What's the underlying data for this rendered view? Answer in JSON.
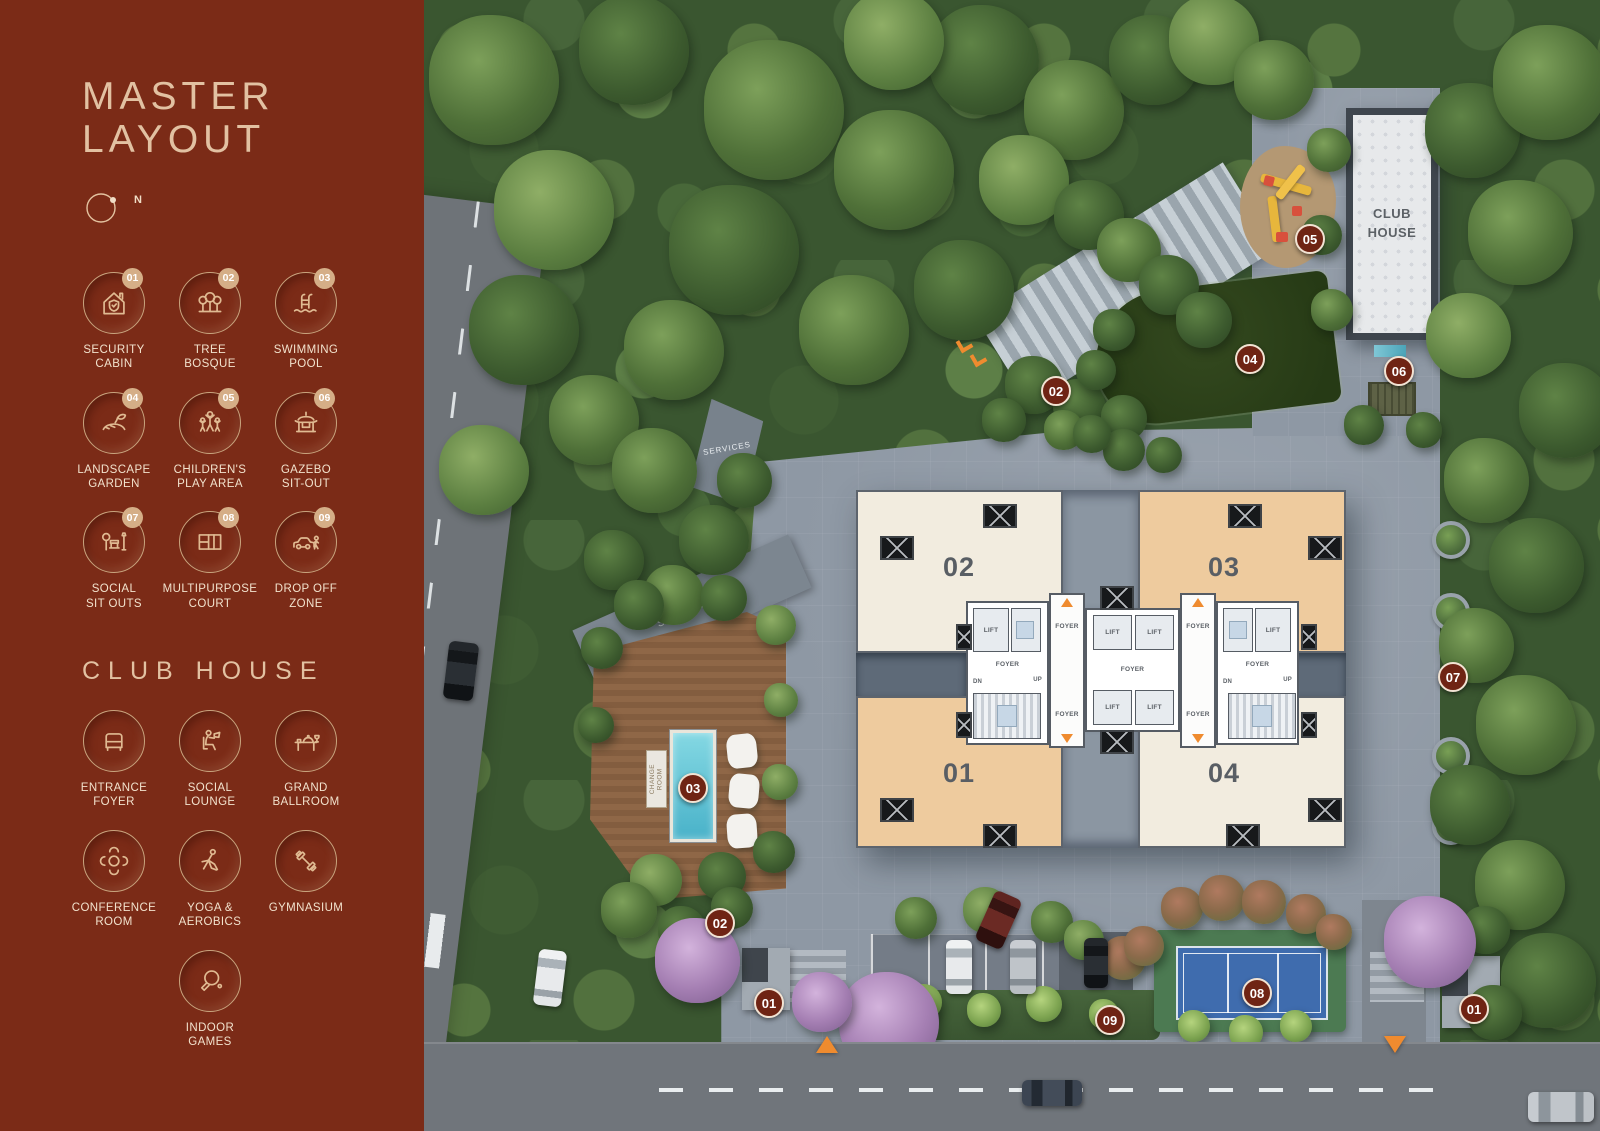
{
  "sidebar": {
    "title": "MASTER\nLAYOUT",
    "compass_label": "N",
    "legend": {
      "items": [
        {
          "number": "01",
          "label": "SECURITY\nCABIN",
          "icon": "security-cabin-icon"
        },
        {
          "number": "02",
          "label": "TREE\nBOSQUE",
          "icon": "tree-bosque-icon"
        },
        {
          "number": "03",
          "label": "SWIMMING\nPOOL",
          "icon": "swimming-pool-icon"
        },
        {
          "number": "04",
          "label": "LANDSCAPE\nGARDEN",
          "icon": "landscape-garden-icon"
        },
        {
          "number": "05",
          "label": "CHILDREN'S\nPLAY AREA",
          "icon": "childrens-play-area-icon"
        },
        {
          "number": "06",
          "label": "GAZEBO\nSIT-OUT",
          "icon": "gazebo-sit-out-icon"
        },
        {
          "number": "07",
          "label": "SOCIAL\nSIT OUTS",
          "icon": "social-sit-outs-icon"
        },
        {
          "number": "08",
          "label": "MULTIPURPOSE\nCOURT",
          "icon": "multipurpose-court-icon"
        },
        {
          "number": "09",
          "label": "DROP OFF\nZONE",
          "icon": "drop-off-zone-icon"
        }
      ]
    },
    "club_house": {
      "heading": "CLUB HOUSE",
      "items": [
        {
          "label": "ENTRANCE\nFOYER",
          "icon": "entrance-foyer-icon"
        },
        {
          "label": "SOCIAL\nLOUNGE",
          "icon": "social-lounge-icon"
        },
        {
          "label": "GRAND\nBALLROOM",
          "icon": "grand-ballroom-icon"
        },
        {
          "label": "CONFERENCE\nROOM",
          "icon": "conference-room-icon"
        },
        {
          "label": "YOGA &\nAEROBICS",
          "icon": "yoga-aerobics-icon"
        },
        {
          "label": "GYMNASIUM",
          "icon": "gymnasium-icon"
        },
        {
          "label": "INDOOR\nGAMES",
          "icon": "indoor-games-icon"
        }
      ]
    }
  },
  "map": {
    "clubhouse_label": "CLUB\nHOUSE",
    "services_label_top": "SERVICES",
    "services_label_pool": "SERVICES",
    "change_room_label": "CHANGE\nROOM",
    "units": {
      "u1": "01",
      "u2": "02",
      "u3": "03",
      "u4": "04"
    },
    "core": {
      "foyer": "FOYER",
      "lift": "LIFT",
      "down": "DN",
      "up": "UP"
    },
    "markers": [
      {
        "number": "05"
      },
      {
        "number": "04"
      },
      {
        "number": "02"
      },
      {
        "number": "06"
      },
      {
        "number": "07"
      },
      {
        "number": "03"
      },
      {
        "number": "02"
      },
      {
        "number": "01"
      },
      {
        "number": "09"
      },
      {
        "number": "08"
      },
      {
        "number": "01"
      }
    ]
  },
  "colors": {
    "sidebar_bg": "#7b2b17",
    "accent_tan": "#e3c2a0",
    "marker_maroon": "#6f2414",
    "entrance_orange": "#ef8b2f",
    "unit_cream": "#f2ecdf",
    "unit_peach": "#eecb9e"
  }
}
